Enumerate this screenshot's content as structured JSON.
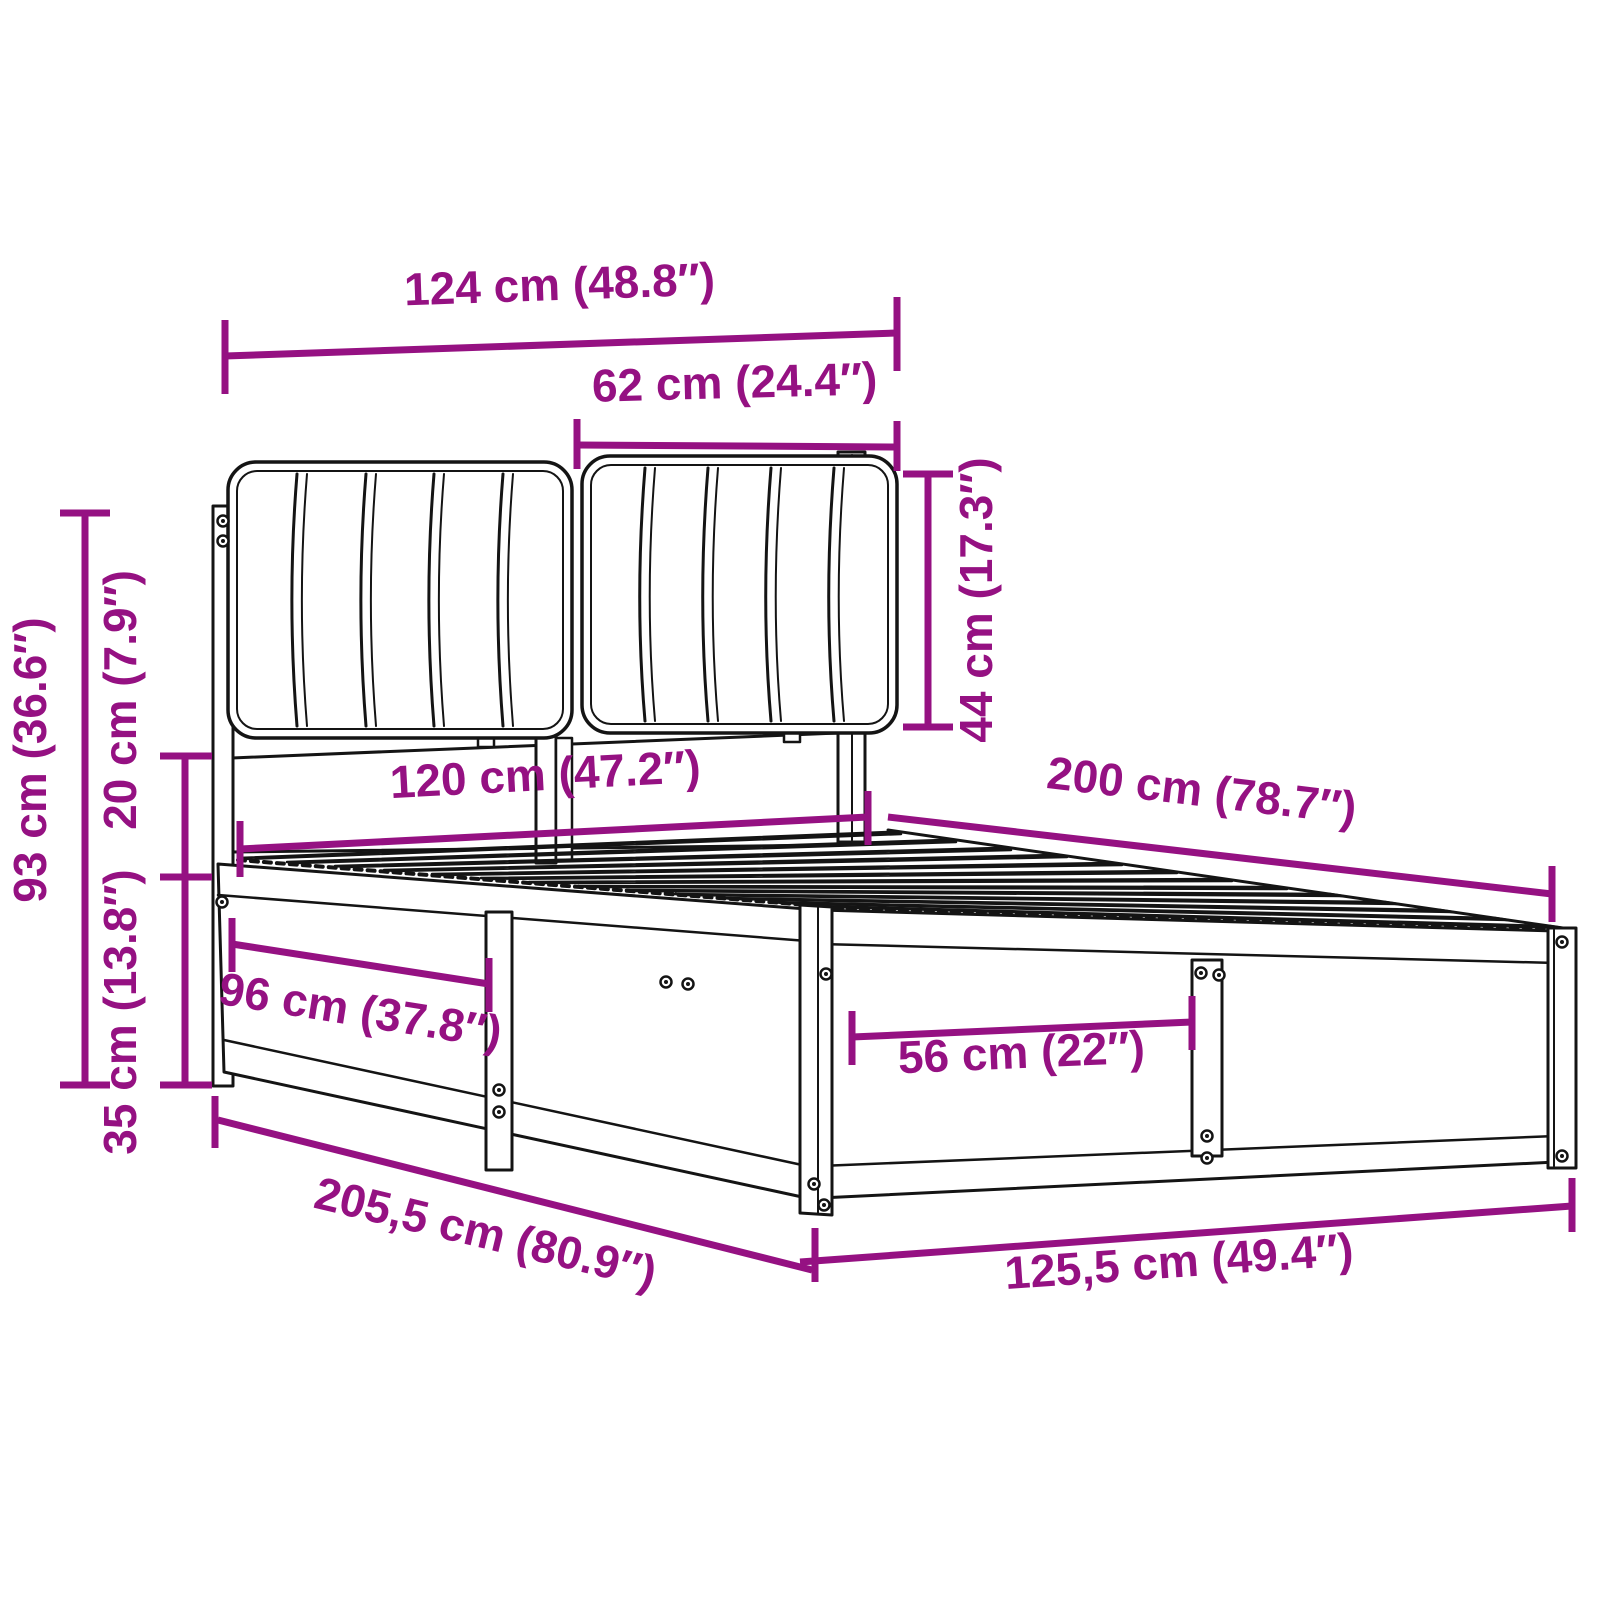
{
  "diagram": {
    "type": "product-dimension-diagram",
    "subject": "bed-frame-with-headboard",
    "colors": {
      "accent": "#951182",
      "line": "#141414",
      "background": "#ffffff"
    },
    "dims": {
      "headboard_width": {
        "cm": 124,
        "inches": 48.8,
        "label": "124 cm (48.8″)"
      },
      "cushion_width": {
        "cm": 62,
        "inches": 24.4,
        "label": "62 cm (24.4″)"
      },
      "cushion_height": {
        "cm": 44,
        "inches": 17.3,
        "label": "44 cm (17.3″)"
      },
      "headboard_height": {
        "cm": 93,
        "inches": 36.6,
        "label": "93 cm (36.6″)"
      },
      "gap_height": {
        "cm": 20,
        "inches": 7.9,
        "label": "20 cm (7.9″)"
      },
      "frame_height": {
        "cm": 35,
        "inches": 13.8,
        "label": "35 cm (13.8″)"
      },
      "mattress_width": {
        "cm": 120,
        "inches": 47.2,
        "label": "120 cm (47.2″)"
      },
      "mattress_length": {
        "cm": 200,
        "inches": 78.7,
        "label": "200 cm (78.7″)"
      },
      "side_section": {
        "cm": 96,
        "inches": 37.8,
        "label": "96 cm (37.8″)"
      },
      "front_section": {
        "cm": 56,
        "inches": 22,
        "label": "56 cm (22″)"
      },
      "total_length": {
        "cm": 205.5,
        "inches": 80.9,
        "label": "205,5 cm (80.9″)"
      },
      "total_width": {
        "cm": 125.5,
        "inches": 49.4,
        "label": "125,5 cm (49.4″)"
      }
    }
  }
}
